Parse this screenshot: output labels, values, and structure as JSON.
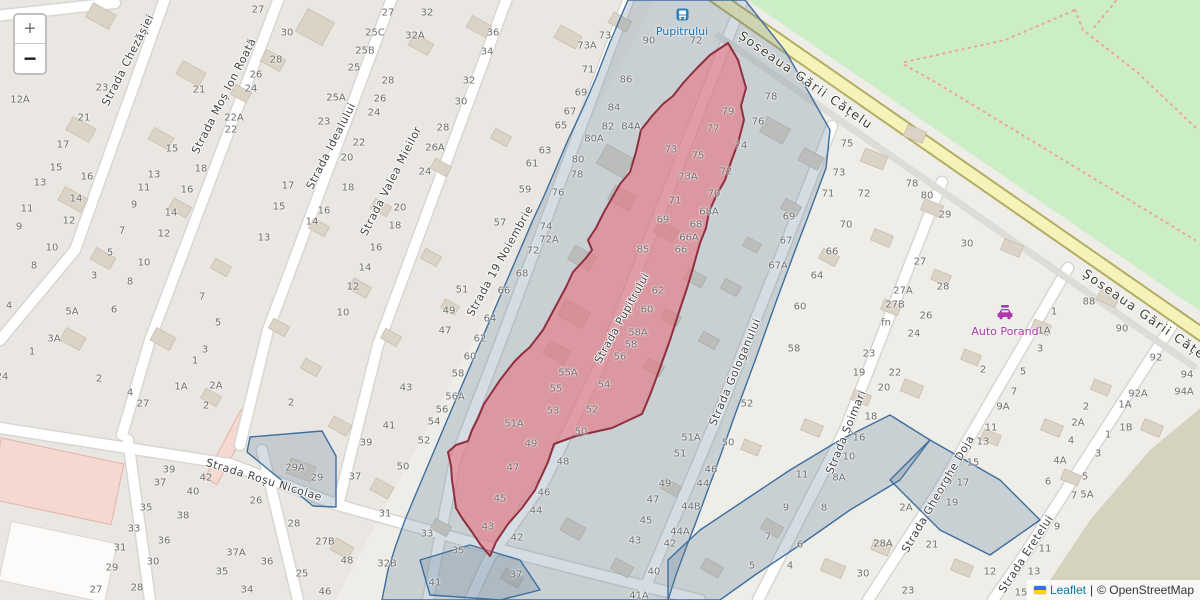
{
  "map": {
    "controls": {
      "zoom_in_label": "+",
      "zoom_out_label": "−"
    },
    "attribution": {
      "flag_icon": "ukraine-flag",
      "leaflet_link": "Leaflet",
      "divider": "|",
      "osm_credit": "© OpenStreetMap"
    },
    "pois": [
      {
        "label": "Pupitrului",
        "type": "bus-stop"
      },
      {
        "label": "Auto Porand",
        "type": "car-repair-shop"
      }
    ],
    "colors": {
      "base": "#efede8",
      "residential": "#e7e4df",
      "park_green": "#cbeec6",
      "olive": "#d5d2bf",
      "road_yellow": "#f6f2ba",
      "road_yellow_casing": "#b3ad62",
      "selection_fill": "#e8737f",
      "selection_stroke": "#8f2f3f",
      "boundary_fill": "#64809c",
      "boundary_stroke": "#3d6e9e",
      "bus_blue": "#1673b6",
      "shop_magenta": "#ac39ac",
      "link_blue": "#0078a8",
      "path_dotted": "#f0a49c"
    },
    "street_labels": [
      {
        "t": "Strada Chezășiei",
        "x": 128,
        "y": 60,
        "r": -63
      },
      {
        "t": "Strada Moș Ion Roată",
        "x": 224,
        "y": 96,
        "r": -63
      },
      {
        "t": "Strada Idealului",
        "x": 331,
        "y": 146,
        "r": -63
      },
      {
        "t": "Strada Valea Mieilor",
        "x": 391,
        "y": 181,
        "r": -63
      },
      {
        "t": "Strada 19 Noiembrie",
        "x": 500,
        "y": 261,
        "r": -61
      },
      {
        "t": "Strada Pupitrului",
        "x": 622,
        "y": 318,
        "r": -61
      },
      {
        "t": "Strada Gologanului",
        "x": 735,
        "y": 372,
        "r": -67
      },
      {
        "t": "Strada Șoimari",
        "x": 846,
        "y": 432,
        "r": -68
      },
      {
        "t": "Strada Gheorghe Doja",
        "x": 938,
        "y": 494,
        "r": -60
      },
      {
        "t": "Strada Eretelui",
        "x": 1026,
        "y": 554,
        "r": -57
      },
      {
        "t": "Strada Roșu Nicolae",
        "x": 264,
        "y": 480,
        "r": 17
      },
      {
        "t": "Șoseaua Gării Cățelu",
        "x": 806,
        "y": 80,
        "r": 35,
        "major": true
      },
      {
        "t": "Șoseaua Gării Cățelu",
        "x": 1150,
        "y": 318,
        "r": 35,
        "major": true
      }
    ],
    "house_numbers": [
      [
        20,
        100,
        "12A"
      ],
      [
        102,
        88,
        "23"
      ],
      [
        84,
        118,
        "21"
      ],
      [
        63,
        145,
        "17"
      ],
      [
        56,
        168,
        "15"
      ],
      [
        40,
        183,
        "13"
      ],
      [
        27,
        209,
        "11"
      ],
      [
        19,
        227,
        "9"
      ],
      [
        87,
        177,
        "16"
      ],
      [
        76,
        199,
        "14"
      ],
      [
        69,
        221,
        "12"
      ],
      [
        52,
        248,
        "10"
      ],
      [
        34,
        266,
        "8"
      ],
      [
        9,
        306,
        "4"
      ],
      [
        2,
        377,
        "24"
      ],
      [
        110,
        253,
        "5"
      ],
      [
        94,
        276,
        "3"
      ],
      [
        32,
        352,
        "1"
      ],
      [
        154,
        175,
        "13"
      ],
      [
        144,
        188,
        "11"
      ],
      [
        134,
        205,
        "9"
      ],
      [
        122,
        231,
        "7"
      ],
      [
        114,
        310,
        "6"
      ],
      [
        201,
        169,
        "18"
      ],
      [
        187,
        190,
        "16"
      ],
      [
        171,
        213,
        "14"
      ],
      [
        164,
        234,
        "12"
      ],
      [
        144,
        263,
        "10"
      ],
      [
        130,
        282,
        "8"
      ],
      [
        72,
        312,
        "5A"
      ],
      [
        54,
        339,
        "3A"
      ],
      [
        99,
        379,
        "2"
      ],
      [
        130,
        393,
        "4"
      ],
      [
        143,
        404,
        "27"
      ],
      [
        195,
        361,
        "1"
      ],
      [
        181,
        387,
        "1A"
      ],
      [
        216,
        386,
        "2A"
      ],
      [
        206,
        406,
        "2"
      ],
      [
        205,
        350,
        "3"
      ],
      [
        218,
        323,
        "5"
      ],
      [
        202,
        297,
        "7"
      ],
      [
        172,
        149,
        "15"
      ],
      [
        199,
        90,
        "21"
      ],
      [
        234,
        118,
        "22A"
      ],
      [
        231,
        130,
        "22"
      ],
      [
        258,
        10,
        "27"
      ],
      [
        287,
        33,
        "30"
      ],
      [
        276,
        60,
        "28"
      ],
      [
        256,
        75,
        "26"
      ],
      [
        251,
        89,
        "24"
      ],
      [
        288,
        186,
        "17"
      ],
      [
        279,
        207,
        "15"
      ],
      [
        264,
        238,
        "13"
      ],
      [
        324,
        122,
        "23"
      ],
      [
        336,
        98,
        "25A"
      ],
      [
        354,
        68,
        "25"
      ],
      [
        365,
        51,
        "25B"
      ],
      [
        375,
        33,
        "25C"
      ],
      [
        388,
        13,
        "27"
      ],
      [
        388,
        81,
        "28"
      ],
      [
        380,
        99,
        "26"
      ],
      [
        374,
        113,
        "24"
      ],
      [
        359,
        143,
        "22"
      ],
      [
        347,
        158,
        "20"
      ],
      [
        348,
        188,
        "18"
      ],
      [
        324,
        211,
        "16"
      ],
      [
        312,
        222,
        "14"
      ],
      [
        365,
        268,
        "14"
      ],
      [
        353,
        287,
        "12"
      ],
      [
        343,
        313,
        "10"
      ],
      [
        427,
        13,
        "32"
      ],
      [
        415,
        36,
        "32A"
      ],
      [
        493,
        33,
        "36"
      ],
      [
        487,
        52,
        "34"
      ],
      [
        469,
        81,
        "32"
      ],
      [
        461,
        102,
        "30"
      ],
      [
        443,
        128,
        "28"
      ],
      [
        435,
        148,
        "26A"
      ],
      [
        425,
        172,
        "24"
      ],
      [
        400,
        208,
        "20"
      ],
      [
        395,
        226,
        "18"
      ],
      [
        376,
        248,
        "16"
      ],
      [
        462,
        290,
        "51"
      ],
      [
        449,
        311,
        "49"
      ],
      [
        445,
        331,
        "47"
      ],
      [
        587,
        46,
        "73A"
      ],
      [
        605,
        36,
        "73"
      ],
      [
        588,
        70,
        "71"
      ],
      [
        581,
        93,
        "69"
      ],
      [
        570,
        112,
        "67"
      ],
      [
        561,
        126,
        "65"
      ],
      [
        545,
        151,
        "63"
      ],
      [
        532,
        164,
        "61"
      ],
      [
        525,
        190,
        "59"
      ],
      [
        500,
        223,
        "57"
      ],
      [
        649,
        41,
        "90"
      ],
      [
        696,
        41,
        "72"
      ],
      [
        626,
        80,
        "86"
      ],
      [
        614,
        108,
        "84"
      ],
      [
        608,
        127,
        "82"
      ],
      [
        631,
        127,
        "84A"
      ],
      [
        594,
        139,
        "80A"
      ],
      [
        578,
        160,
        "80"
      ],
      [
        577,
        175,
        "78"
      ],
      [
        558,
        193,
        "76"
      ],
      [
        546,
        227,
        "74"
      ],
      [
        549,
        240,
        "72A"
      ],
      [
        533,
        251,
        "72"
      ],
      [
        522,
        274,
        "68"
      ],
      [
        504,
        291,
        "66"
      ],
      [
        490,
        319,
        "64"
      ],
      [
        480,
        339,
        "62"
      ],
      [
        470,
        357,
        "60"
      ],
      [
        458,
        374,
        "58"
      ],
      [
        455,
        397,
        "56A"
      ],
      [
        442,
        410,
        "56"
      ],
      [
        434,
        422,
        "54"
      ],
      [
        424,
        441,
        "52"
      ],
      [
        403,
        467,
        "50"
      ],
      [
        366,
        443,
        "39"
      ],
      [
        355,
        477,
        "37"
      ],
      [
        406,
        388,
        "43"
      ],
      [
        389,
        426,
        "41"
      ],
      [
        291,
        403,
        "2"
      ],
      [
        728,
        112,
        "79"
      ],
      [
        713,
        129,
        "77"
      ],
      [
        698,
        156,
        "75"
      ],
      [
        671,
        150,
        "73"
      ],
      [
        688,
        177,
        "73A"
      ],
      [
        675,
        201,
        "71"
      ],
      [
        663,
        220,
        "69"
      ],
      [
        643,
        250,
        "85"
      ],
      [
        568,
        373,
        "55A"
      ],
      [
        556,
        389,
        "55"
      ],
      [
        553,
        411,
        "53"
      ],
      [
        514,
        424,
        "51A"
      ],
      [
        531,
        444,
        "49"
      ],
      [
        513,
        468,
        "47"
      ],
      [
        500,
        499,
        "45"
      ],
      [
        488,
        527,
        "43"
      ],
      [
        771,
        97,
        "78"
      ],
      [
        758,
        122,
        "76"
      ],
      [
        741,
        146,
        "74"
      ],
      [
        726,
        172,
        "72"
      ],
      [
        714,
        194,
        "70"
      ],
      [
        709,
        212,
        "68A"
      ],
      [
        696,
        225,
        "68"
      ],
      [
        689,
        238,
        "66A"
      ],
      [
        681,
        250,
        "66"
      ],
      [
        658,
        291,
        "62"
      ],
      [
        647,
        310,
        "60"
      ],
      [
        638,
        333,
        "58A"
      ],
      [
        631,
        345,
        "58"
      ],
      [
        620,
        357,
        "56"
      ],
      [
        604,
        385,
        "54"
      ],
      [
        592,
        410,
        "52"
      ],
      [
        581,
        432,
        "50"
      ],
      [
        563,
        462,
        "48"
      ],
      [
        544,
        493,
        "46"
      ],
      [
        536,
        511,
        "44"
      ],
      [
        517,
        538,
        "42"
      ],
      [
        516,
        575,
        "37"
      ],
      [
        295,
        468,
        "29A"
      ],
      [
        317,
        478,
        "29"
      ],
      [
        385,
        514,
        "31"
      ],
      [
        427,
        534,
        "33"
      ],
      [
        458,
        551,
        "35"
      ],
      [
        347,
        561,
        "48"
      ],
      [
        387,
        564,
        "32B"
      ],
      [
        435,
        583,
        "41"
      ],
      [
        325,
        592,
        "46"
      ],
      [
        302,
        574,
        "25"
      ],
      [
        267,
        562,
        "36"
      ],
      [
        247,
        590,
        "34"
      ],
      [
        294,
        524,
        "28"
      ],
      [
        325,
        542,
        "27B"
      ],
      [
        256,
        501,
        "26"
      ],
      [
        169,
        470,
        "39"
      ],
      [
        160,
        483,
        "37"
      ],
      [
        146,
        508,
        "35"
      ],
      [
        134,
        529,
        "33"
      ],
      [
        120,
        548,
        "31"
      ],
      [
        112,
        568,
        "29"
      ],
      [
        96,
        590,
        "27"
      ],
      [
        206,
        478,
        "42"
      ],
      [
        193,
        492,
        "40"
      ],
      [
        183,
        516,
        "38"
      ],
      [
        164,
        541,
        "36"
      ],
      [
        153,
        562,
        "30"
      ],
      [
        137,
        588,
        "28"
      ],
      [
        236,
        553,
        "37A"
      ],
      [
        222,
        572,
        "35"
      ],
      [
        653,
        500,
        "47"
      ],
      [
        646,
        521,
        "45"
      ],
      [
        635,
        541,
        "43"
      ],
      [
        654,
        572,
        "40"
      ],
      [
        639,
        596,
        "41A"
      ],
      [
        747,
        404,
        "52"
      ],
      [
        691,
        438,
        "51A"
      ],
      [
        680,
        454,
        "51"
      ],
      [
        728,
        443,
        "50"
      ],
      [
        711,
        470,
        "46"
      ],
      [
        703,
        484,
        "44"
      ],
      [
        665,
        484,
        "49"
      ],
      [
        691,
        507,
        "44B"
      ],
      [
        680,
        532,
        "44A"
      ],
      [
        670,
        544,
        "42"
      ],
      [
        802,
        475,
        "11"
      ],
      [
        786,
        508,
        "9"
      ],
      [
        768,
        537,
        "7"
      ],
      [
        752,
        566,
        "5"
      ],
      [
        839,
        478,
        "8A"
      ],
      [
        824,
        508,
        "8"
      ],
      [
        800,
        545,
        "6"
      ],
      [
        790,
        566,
        "4"
      ],
      [
        871,
        417,
        "18"
      ],
      [
        859,
        438,
        "16"
      ],
      [
        849,
        457,
        "10"
      ],
      [
        883,
        544,
        "28A"
      ],
      [
        863,
        574,
        "30"
      ],
      [
        920,
        262,
        "27"
      ],
      [
        903,
        291,
        "27A"
      ],
      [
        895,
        305,
        "27B"
      ],
      [
        886,
        323,
        "fn"
      ],
      [
        926,
        316,
        "26"
      ],
      [
        914,
        334,
        "24"
      ],
      [
        869,
        354,
        "23"
      ],
      [
        895,
        373,
        "22"
      ],
      [
        884,
        388,
        "20"
      ],
      [
        859,
        373,
        "19"
      ],
      [
        943,
        287,
        "28"
      ],
      [
        967,
        244,
        "30"
      ],
      [
        945,
        215,
        "29"
      ],
      [
        912,
        184,
        "78"
      ],
      [
        927,
        196,
        "80"
      ],
      [
        832,
        252,
        "66"
      ],
      [
        817,
        276,
        "64"
      ],
      [
        800,
        307,
        "60"
      ],
      [
        794,
        349,
        "58"
      ],
      [
        778,
        266,
        "67A"
      ],
      [
        786,
        241,
        "67"
      ],
      [
        789,
        217,
        "69"
      ],
      [
        846,
        225,
        "70"
      ],
      [
        828,
        194,
        "71"
      ],
      [
        864,
        194,
        "72"
      ],
      [
        839,
        173,
        "73"
      ],
      [
        847,
        144,
        "75"
      ],
      [
        983,
        370,
        "2"
      ],
      [
        1023,
        372,
        "5"
      ],
      [
        1014,
        392,
        "7"
      ],
      [
        1003,
        407,
        "9A"
      ],
      [
        991,
        428,
        "11"
      ],
      [
        983,
        442,
        "13"
      ],
      [
        973,
        463,
        "15"
      ],
      [
        963,
        483,
        "17"
      ],
      [
        952,
        503,
        "19"
      ],
      [
        932,
        545,
        "21"
      ],
      [
        908,
        591,
        "23"
      ],
      [
        906,
        508,
        "2A"
      ],
      [
        990,
        572,
        "12"
      ],
      [
        1048,
        482,
        "6"
      ],
      [
        1060,
        461,
        "4A"
      ],
      [
        1071,
        441,
        "4"
      ],
      [
        1078,
        423,
        "2A"
      ],
      [
        1086,
        407,
        "2"
      ],
      [
        1057,
        527,
        "9"
      ],
      [
        1045,
        549,
        "11"
      ],
      [
        1034,
        572,
        "13"
      ],
      [
        1021,
        593,
        "15"
      ],
      [
        1085,
        477,
        "5"
      ],
      [
        1087,
        495,
        "5A"
      ],
      [
        1074,
        496,
        "7"
      ],
      [
        1098,
        454,
        "3"
      ],
      [
        1108,
        435,
        "1"
      ],
      [
        1126,
        428,
        "1B"
      ],
      [
        1125,
        405,
        "1A"
      ],
      [
        1089,
        302,
        "88"
      ],
      [
        1122,
        329,
        "90"
      ],
      [
        1156,
        358,
        "92"
      ],
      [
        1187,
        375,
        "94"
      ],
      [
        1138,
        394,
        "92A"
      ],
      [
        1184,
        392,
        "94A"
      ],
      [
        1054,
        312,
        "1"
      ],
      [
        1044,
        331,
        "1A"
      ],
      [
        1040,
        349,
        "3"
      ]
    ]
  }
}
